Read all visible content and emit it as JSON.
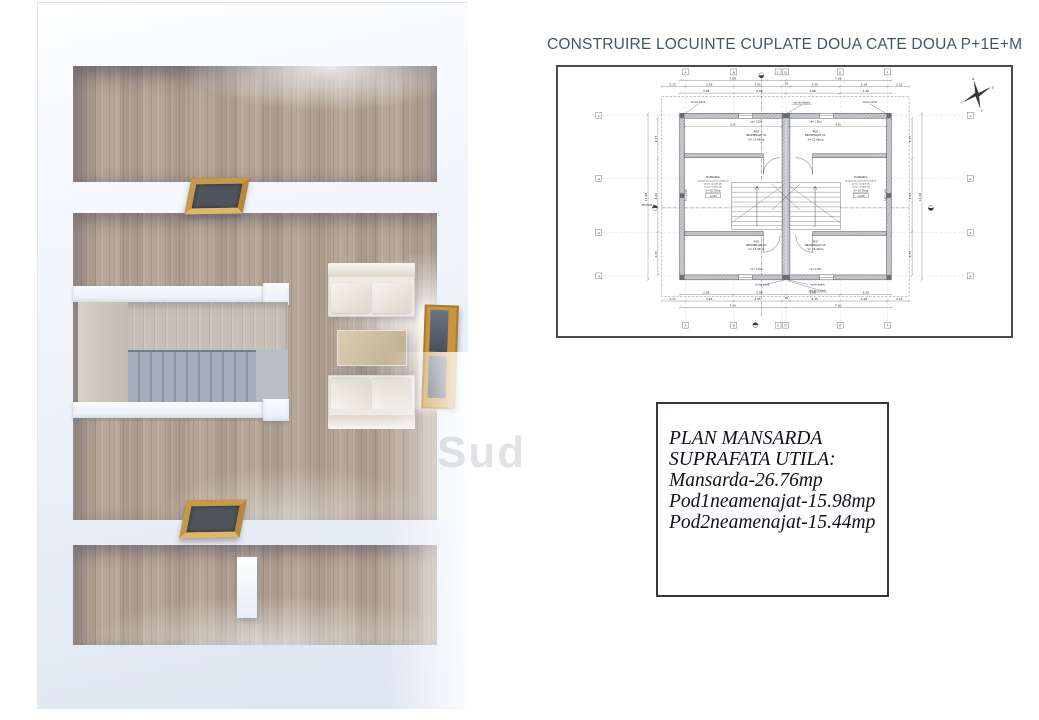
{
  "title": "CONSTRUIRE LOCUINTE CUPLATE DOUA CATE DOUA P+1E+M",
  "watermark": "Sud",
  "legend": {
    "lines": [
      "PLAN MANSARDA",
      "SUPRAFATA UTILA:",
      "Mansarda-26.76mp",
      "Pod1neamenajat-15.98mp",
      "Pod2neamenajat-15.44mp"
    ]
  },
  "plan": {
    "grid_cols": [
      "A",
      "B",
      "C",
      "D",
      "E",
      "F"
    ],
    "grid_rows": [
      "1",
      "2",
      "3",
      "4"
    ],
    "dims": {
      "top_overall": [
        "7.08",
        "7.08"
      ],
      "top_mid": [
        "2.15",
        "3.28",
        "3.35",
        ".35",
        "3.35",
        "3.28",
        "2.15"
      ],
      "top_inner": [
        "3.28",
        "3.88",
        "3.88",
        "3.28"
      ],
      "bottom_inner": [
        "3.28",
        "3.88",
        "3.88",
        "3.28"
      ],
      "bottom_mid": [
        "2.15",
        "3.28",
        "3.35",
        ".35",
        "3.35",
        "3.28",
        "2.15"
      ],
      "bottom_overall": [
        "7.00",
        "7.00"
      ],
      "left_inner": [
        "2.73",
        "4.45",
        "4.33"
      ],
      "left_total": "11.48",
      "right_inner": [
        "2.73",
        "4.45",
        "4.33"
      ],
      "right_total": "11.48",
      "pod_width": "6.30"
    },
    "rooms": {
      "pod1": {
        "name": "POD",
        "name2": "NEAMENAJAT 01",
        "area": "S= 15.98mp"
      },
      "pod1b": {
        "name": "POD",
        "name2": "NEAMENAJAT 01'",
        "area": "S= 15.98mp"
      },
      "pod2": {
        "name": "POD",
        "name2": "NEAMENAJAT 02",
        "area": "S= 15.44mp"
      },
      "pod2b": {
        "name": "POD",
        "name2": "NEAMENAJAT 02'",
        "area": "S= 15.44mp"
      },
      "mansarda": {
        "name": "MANSARDA",
        "finish1": "pardoseala: parchet stratificat",
        "finish2": "pereti: lavabil alb",
        "finish3": "tavan: lavabil alb",
        "area": "S= 26.76mp",
        "level": "+2.85"
      }
    },
    "annotations": {
      "downspout": "burlan patrat",
      "joint": "rost de dilatatie",
      "section": "SECTIUNE 1",
      "hp_top": "hp= 1.80m",
      "hp_side": "hp= 1.10m",
      "hp_bottom": "hp= 1.40m"
    },
    "compass": {
      "n": "N",
      "e": "E",
      "s": "S",
      "v": "V"
    }
  },
  "colors": {
    "title_text": "#44546A",
    "legend_text": "#10101c",
    "plan_lines": "#3c3c3c",
    "wood_floor": "#b1a294",
    "wood_frame": "#c8963e"
  }
}
